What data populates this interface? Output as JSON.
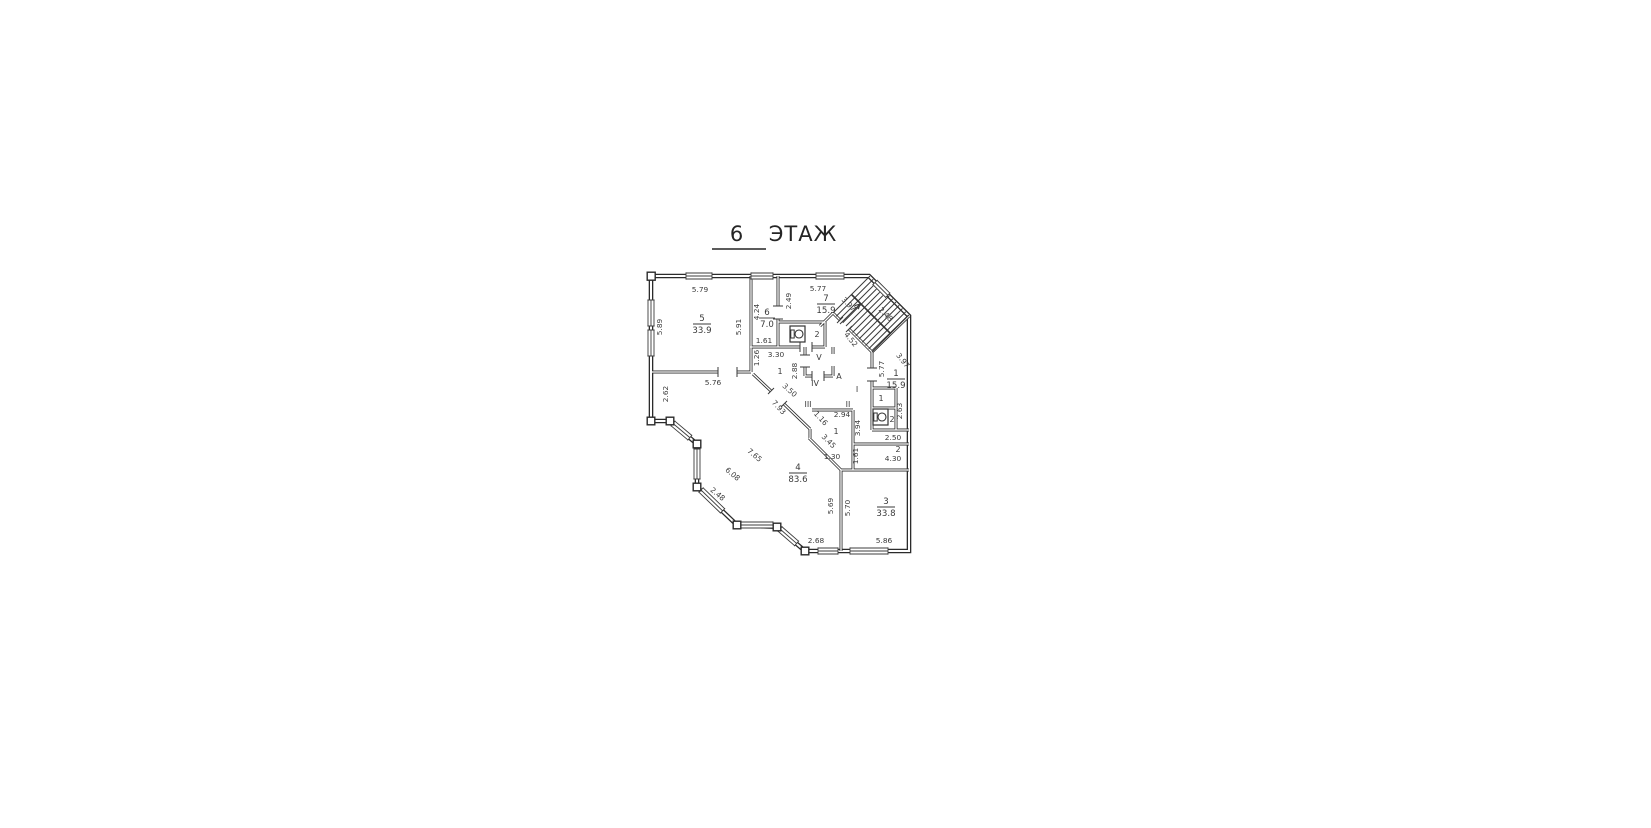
{
  "title": {
    "number": "6",
    "word": "ЭТАЖ"
  },
  "rooms": [
    {
      "number": "5",
      "area": "33.9"
    },
    {
      "number": "6",
      "area": "7.0"
    },
    {
      "number": "7",
      "area": "15.9"
    },
    {
      "number": "1",
      "area": "15.9"
    },
    {
      "number": "4",
      "area": "83.6"
    },
    {
      "number": "3",
      "area": "33.8"
    }
  ],
  "dims": [
    "5.79",
    "5.89",
    "5.91",
    "4.24",
    "1.61",
    "2.49",
    "5.77",
    "3.97",
    "2.48",
    "4.52",
    "3.97",
    "5.77",
    "1.26",
    "3.30",
    "2.88",
    "3.50",
    "5.76",
    "2.62",
    "7.93",
    "2.94",
    "1.16",
    "3.45",
    "3.94",
    "2.63",
    "2.50",
    "1.61",
    "4.30",
    "1.30",
    "7.65",
    "6.08",
    "2.48",
    "5.69",
    "5.70",
    "2.68",
    "5.86"
  ],
  "zones": [
    "2",
    "V",
    "A",
    "IV",
    "III",
    "1",
    "I",
    "II",
    "1",
    "2",
    "1",
    "2"
  ]
}
